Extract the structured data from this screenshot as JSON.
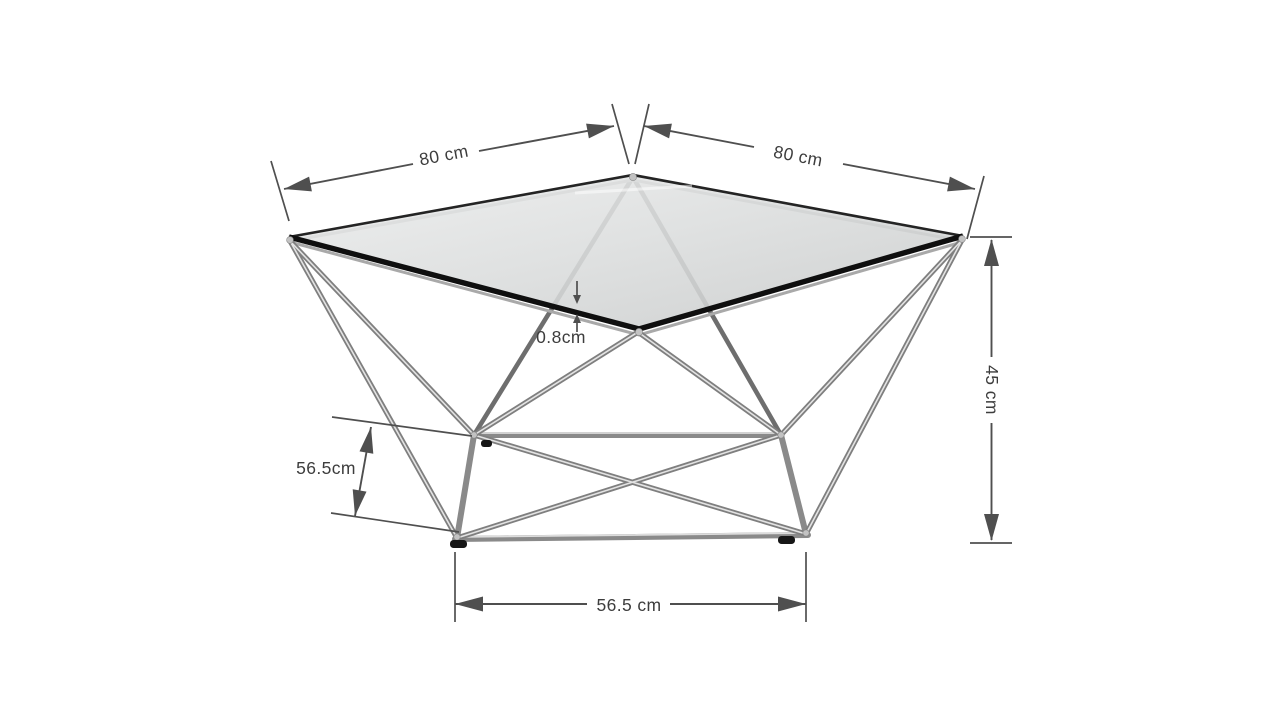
{
  "page": {
    "background": "#ffffff"
  },
  "diagram": {
    "type": "product-dimension-diagram",
    "subject": "geometric diamond coffee table with smoked glass top and chrome frame",
    "colors": {
      "dimension_lines": "#4f4f4f",
      "label_text": "#3d3d3d",
      "frame_metal": "#8a8a8a",
      "glass_edge": "#0f0f0f",
      "glass_fill_light": "#e9eaea",
      "glass_fill_dark": "#cbcdcd",
      "background": "#ffffff"
    },
    "dimensions": {
      "top_left_edge": {
        "label": "80 cm"
      },
      "top_right_edge": {
        "label": "80 cm"
      },
      "glass_thickness": {
        "label": "0.8cm"
      },
      "height": {
        "label": "45 cm"
      },
      "base_depth": {
        "label": "56.5cm"
      },
      "base_width": {
        "label": "56.5 cm"
      }
    }
  }
}
